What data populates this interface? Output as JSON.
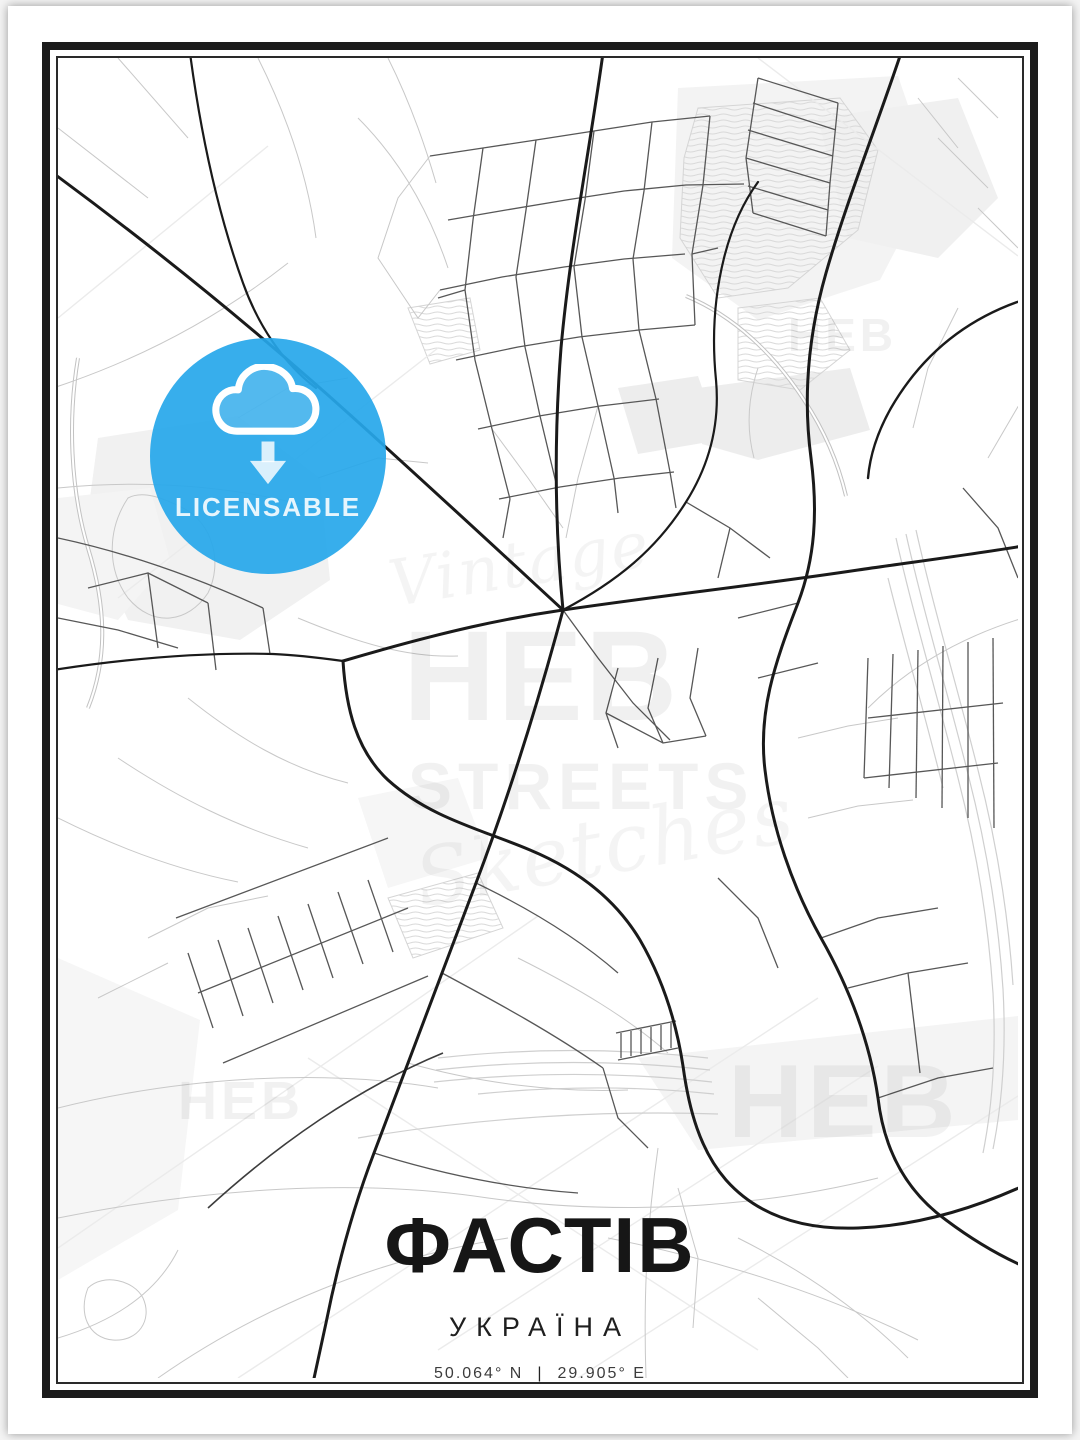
{
  "poster": {
    "title": "ФАСТІВ",
    "subtitle": "УКРАЇНА",
    "coordinates": {
      "lat": "50.064° N",
      "separator": "|",
      "lon": "29.905° E"
    }
  },
  "badge": {
    "label": "LICENSABLE",
    "icon": "cloud-download-icon",
    "background_color": "#29A9E9",
    "icon_color": "#FFFFFF"
  },
  "watermark": {
    "brand": "HEB",
    "word": "STREETS",
    "script_top": "Vintage",
    "script_bottom": "Sketches"
  },
  "map": {
    "colors": {
      "background": "#FFFFFF",
      "area_fill": "#F1F1F1",
      "contour_hatch": "#D9D9D9",
      "road_main": "#1A1A1A",
      "road_medium": "#575757",
      "road_minor": "#C8C8C8",
      "railway": "#CFCFCF",
      "frame": "#1B1B1B"
    }
  }
}
